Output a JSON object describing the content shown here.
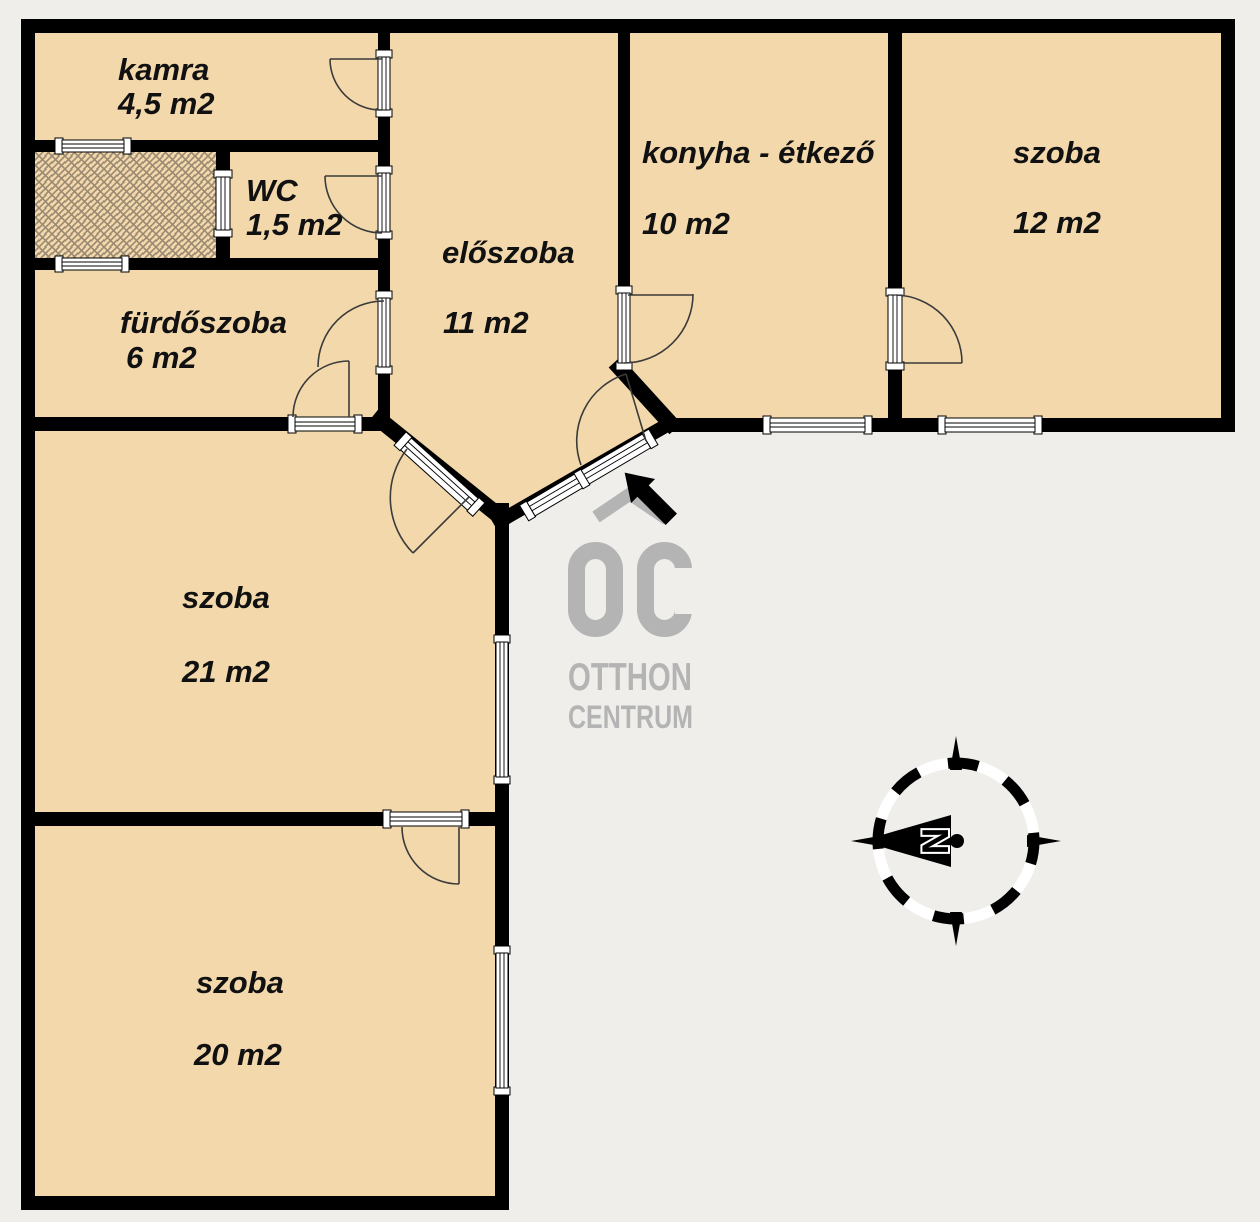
{
  "plan": {
    "background": "#efeeea",
    "room_fill": "#f2d8ab",
    "wall_color": "#000000",
    "hatch_line_color": "#9a8a73",
    "watermark_gray": "#b4b4b4"
  },
  "rooms": [
    {
      "name": "kamra",
      "area": "4,5 m2"
    },
    {
      "name": "WC",
      "area": "1,5 m2"
    },
    {
      "name": "fürdőszoba",
      "area": "6 m2"
    },
    {
      "name": "előszoba",
      "area": "11 m2"
    },
    {
      "name": "konyha - étkező",
      "area": "10 m2"
    },
    {
      "name": "szoba",
      "area": "12 m2"
    },
    {
      "name": "szoba",
      "area": "21 m2"
    },
    {
      "name": "szoba",
      "area": "20 m2"
    }
  ],
  "logo": {
    "monogram": "OC",
    "word_top": "OTTHON",
    "word_bottom": "CENTRUM"
  },
  "compass": {
    "north_label": "N"
  }
}
